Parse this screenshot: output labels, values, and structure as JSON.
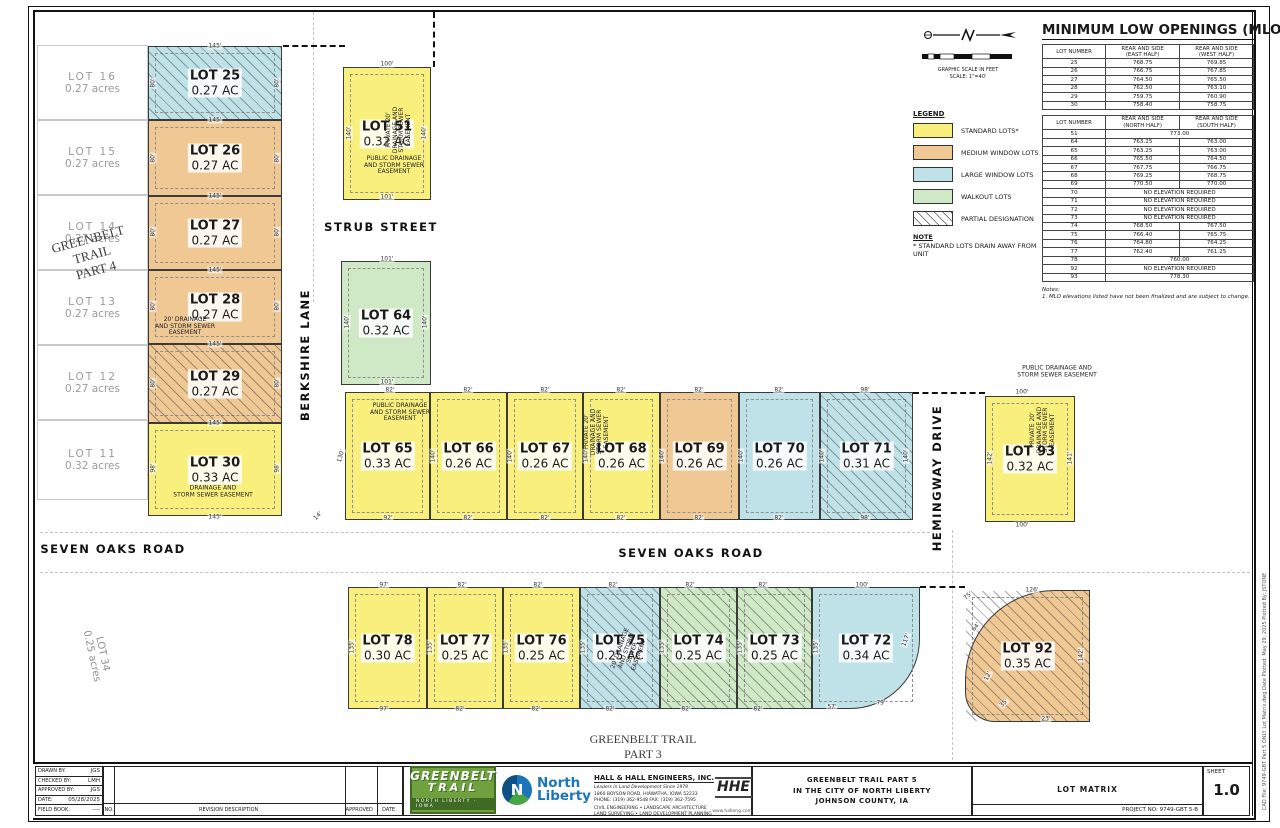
{
  "colors": {
    "standard": "#F8EF7D",
    "medium": "#EFC894",
    "large": "#BFE2E8",
    "walkout": "#CFE8C5",
    "hatch_line": "#555555"
  },
  "mlo": {
    "title": "MINIMUM LOW OPENINGS (MLO):",
    "tables": [
      {
        "headers": [
          "LOT NUMBER",
          "REAR AND SIDE\n(EAST HALF)",
          "REAR AND SIDE\n(WEST HALF)"
        ],
        "rows": [
          [
            "25",
            "768.75",
            "769.85"
          ],
          [
            "26",
            "766.75",
            "767.85"
          ],
          [
            "27",
            "764.50",
            "765.50"
          ],
          [
            "28",
            "762.50",
            "763.10"
          ],
          [
            "29",
            "759.75",
            "760.90"
          ],
          [
            "30",
            "758.40",
            "758.75"
          ]
        ]
      },
      {
        "headers": [
          "LOT NUMBER",
          "REAR AND SIDE\n(NORTH HALF)",
          "REAR AND SIDE\n(SOUTH HALF)"
        ],
        "rows": [
          [
            "51",
            "773.00",
            null
          ],
          [
            "64",
            "763.25",
            "763.00"
          ],
          [
            "65",
            "763.25",
            "763.00"
          ],
          [
            "66",
            "765.50",
            "764.50"
          ],
          [
            "67",
            "767.75",
            "766.75"
          ],
          [
            "68",
            "769.25",
            "768.75"
          ],
          [
            "69",
            "770.50",
            "770.00"
          ],
          [
            "70",
            "NO ELEVATION REQUIRED",
            null
          ],
          [
            "71",
            "NO ELEVATION REQUIRED",
            null
          ],
          [
            "72",
            "NO ELEVATION REQUIRED",
            null
          ],
          [
            "73",
            "NO ELEVATION REQUIRED",
            null
          ],
          [
            "74",
            "768.50",
            "767.50"
          ],
          [
            "75",
            "766.40",
            "765.75"
          ],
          [
            "76",
            "764.80",
            "764.25"
          ],
          [
            "77",
            "762.40",
            "761.25"
          ],
          [
            "78",
            "760.00",
            null
          ],
          [
            "92",
            "NO ELEVATION REQUIRED",
            null
          ],
          [
            "93",
            "778.30",
            null
          ]
        ]
      }
    ],
    "notes_label": "Notes:",
    "notes": "1.  MLO elevations listed have not been finalized and are subject to change."
  },
  "legend": {
    "title": "LEGEND",
    "items": [
      {
        "label": "STANDARD LOTS*",
        "type": "standard",
        "hatch": false
      },
      {
        "label": "MEDIUM WINDOW LOTS",
        "type": "medium",
        "hatch": false
      },
      {
        "label": "LARGE WINDOW LOTS",
        "type": "large",
        "hatch": false
      },
      {
        "label": "WALKOUT LOTS",
        "type": "walkout",
        "hatch": false
      },
      {
        "label": "PARTIAL DESIGNATION",
        "type": "none",
        "hatch": true
      }
    ],
    "note_title": "NOTE",
    "note": "* STANDARD LOTS DRAIN AWAY FROM UNIT"
  },
  "scale": {
    "caption1": "GRAPHIC SCALE IN FEET",
    "caption2": "SCALE: 1\"=40'"
  },
  "lots": [
    {
      "id": "25",
      "name": "LOT 25",
      "ac": "0.27 AC",
      "x": 148,
      "y": 46,
      "w": 134,
      "h": 74,
      "type": "large",
      "hatch": true
    },
    {
      "id": "26",
      "name": "LOT 26",
      "ac": "0.27 AC",
      "x": 148,
      "y": 120,
      "w": 134,
      "h": 76,
      "type": "medium",
      "hatch": false
    },
    {
      "id": "27",
      "name": "LOT 27",
      "ac": "0.27 AC",
      "x": 148,
      "y": 196,
      "w": 134,
      "h": 74,
      "type": "medium",
      "hatch": false
    },
    {
      "id": "28",
      "name": "LOT 28",
      "ac": "0.27 AC",
      "x": 148,
      "y": 270,
      "w": 134,
      "h": 74,
      "type": "medium",
      "hatch": false
    },
    {
      "id": "29",
      "name": "LOT 29",
      "ac": "0.27 AC",
      "x": 148,
      "y": 344,
      "w": 134,
      "h": 79,
      "type": "medium",
      "hatch": true
    },
    {
      "id": "30",
      "name": "LOT 30",
      "ac": "0.33 AC",
      "x": 148,
      "y": 423,
      "w": 134,
      "h": 93,
      "type": "standard",
      "hatch": false
    },
    {
      "id": "51",
      "name": "LOT 51",
      "ac": "0.32 AC",
      "x": 343,
      "y": 67,
      "w": 88,
      "h": 133,
      "type": "standard",
      "hatch": false
    },
    {
      "id": "64",
      "name": "LOT 64",
      "ac": "0.32 AC",
      "x": 341,
      "y": 261,
      "w": 90,
      "h": 124,
      "type": "walkout",
      "hatch": false
    },
    {
      "id": "65",
      "name": "LOT 65",
      "ac": "0.33 AC",
      "x": 345,
      "y": 392,
      "w": 85,
      "h": 128,
      "type": "standard",
      "hatch": false
    },
    {
      "id": "66",
      "name": "LOT 66",
      "ac": "0.26 AC",
      "x": 430,
      "y": 392,
      "w": 77,
      "h": 128,
      "type": "standard",
      "hatch": false
    },
    {
      "id": "67",
      "name": "LOT 67",
      "ac": "0.26 AC",
      "x": 507,
      "y": 392,
      "w": 76,
      "h": 128,
      "type": "standard",
      "hatch": false
    },
    {
      "id": "68",
      "name": "LOT 68",
      "ac": "0.26 AC",
      "x": 583,
      "y": 392,
      "w": 77,
      "h": 128,
      "type": "standard",
      "hatch": false
    },
    {
      "id": "69",
      "name": "LOT 69",
      "ac": "0.26 AC",
      "x": 660,
      "y": 392,
      "w": 79,
      "h": 128,
      "type": "medium",
      "hatch": false
    },
    {
      "id": "70",
      "name": "LOT 70",
      "ac": "0.26 AC",
      "x": 739,
      "y": 392,
      "w": 81,
      "h": 128,
      "type": "large",
      "hatch": false
    },
    {
      "id": "71",
      "name": "LOT 71",
      "ac": "0.31 AC",
      "x": 820,
      "y": 392,
      "w": 93,
      "h": 128,
      "type": "large",
      "hatch": true
    },
    {
      "id": "93",
      "name": "LOT 93",
      "ac": "0.32 AC",
      "x": 985,
      "y": 396,
      "w": 90,
      "h": 126,
      "type": "standard",
      "hatch": false
    },
    {
      "id": "78",
      "name": "LOT 78",
      "ac": "0.30 AC",
      "x": 348,
      "y": 587,
      "w": 79,
      "h": 122,
      "type": "standard",
      "hatch": false
    },
    {
      "id": "77",
      "name": "LOT 77",
      "ac": "0.25 AC",
      "x": 427,
      "y": 587,
      "w": 76,
      "h": 122,
      "type": "standard",
      "hatch": false
    },
    {
      "id": "76",
      "name": "LOT 76",
      "ac": "0.25 AC",
      "x": 503,
      "y": 587,
      "w": 77,
      "h": 122,
      "type": "standard",
      "hatch": false
    },
    {
      "id": "75",
      "name": "LOT 75",
      "ac": "0.25 AC",
      "x": 580,
      "y": 587,
      "w": 80,
      "h": 122,
      "type": "large",
      "hatch": true
    },
    {
      "id": "74",
      "name": "LOT 74",
      "ac": "0.25 AC",
      "x": 660,
      "y": 587,
      "w": 77,
      "h": 122,
      "type": "walkout",
      "hatch": true
    },
    {
      "id": "73",
      "name": "LOT 73",
      "ac": "0.25 AC",
      "x": 737,
      "y": 587,
      "w": 75,
      "h": 122,
      "type": "walkout",
      "hatch": true
    },
    {
      "id": "72",
      "name": "LOT 72",
      "ac": "0.34 AC",
      "x": 812,
      "y": 587,
      "w": 108,
      "h": 122,
      "type": "large",
      "hatch": false,
      "radius": "0 0 70px 0"
    },
    {
      "id": "92",
      "name": "LOT 92",
      "ac": "0.35 AC",
      "x": 965,
      "y": 590,
      "w": 125,
      "h": 132,
      "type": "medium",
      "hatch": true,
      "radius": "90px 0 0 30px"
    }
  ],
  "ghost_lots": [
    {
      "name": "LOT 16",
      "acres": "0.27 acres",
      "x": 37,
      "y": 45,
      "w": 111,
      "h": 75
    },
    {
      "name": "LOT 15",
      "acres": "0.27 acres",
      "x": 37,
      "y": 120,
      "w": 111,
      "h": 75
    },
    {
      "name": "LOT 14",
      "acres": "0.27 acres",
      "x": 37,
      "y": 195,
      "w": 111,
      "h": 75
    },
    {
      "name": "LOT 13",
      "acres": "0.27 acres",
      "x": 37,
      "y": 270,
      "w": 111,
      "h": 75
    },
    {
      "name": "LOT 12",
      "acres": "0.27 acres",
      "x": 37,
      "y": 345,
      "w": 111,
      "h": 75
    },
    {
      "name": "LOT 11",
      "acres": "0.32 acres",
      "x": 37,
      "y": 420,
      "w": 111,
      "h": 80
    }
  ],
  "ghost_labels": [
    {
      "t": "GREENBELT\nTRAIL\nPART  4",
      "x": 92,
      "y": 255,
      "r": -15,
      "size": 13,
      "dark": true
    },
    {
      "t": "GREENBELT  TRAIL\nPART  3",
      "x": 643,
      "y": 747,
      "r": 0,
      "size": 12,
      "dark": true
    },
    {
      "t": "LOT 34\n0.25 acres",
      "x": 97,
      "y": 655,
      "r": 78,
      "size": 10,
      "dark": false
    }
  ],
  "streets": [
    {
      "t": "STRUB STREET",
      "x": 381,
      "y": 227,
      "r": 0
    },
    {
      "t": "BERKSHIRE LANE",
      "x": 305,
      "y": 355,
      "r": -90
    },
    {
      "t": "SEVEN OAKS ROAD",
      "x": 113,
      "y": 549,
      "r": 0
    },
    {
      "t": "SEVEN OAKS ROAD",
      "x": 691,
      "y": 553,
      "r": 0
    },
    {
      "t": "HEMINGWAY DRIVE",
      "x": 937,
      "y": 478,
      "r": -90
    }
  ],
  "annotations": [
    {
      "t": "PRIVATE 20'\nDRAINAGE AND\nSTORM SEWER\nEASEMENT",
      "x": 399,
      "y": 130,
      "r": -90
    },
    {
      "t": "PUBLIC DRAINAGE\nAND STORM SEWER\nEASEMENT",
      "x": 394,
      "y": 166,
      "r": 0
    },
    {
      "t": "20' DRAINAGE\nAND STORM SEWER\nEASEMENT",
      "x": 185,
      "y": 327,
      "r": 0
    },
    {
      "t": "DRAINAGE AND\nSTORM SEWER EASEMENT",
      "x": 213,
      "y": 492,
      "r": 0
    },
    {
      "t": "PUBLIC DRAINAGE\nAND STORM SEWER\nEASEMENT",
      "x": 400,
      "y": 413,
      "r": 0
    },
    {
      "t": "PRIVATE 20'\nDRAINAGE AND\nSTORM SEWER\nEASEMENT",
      "x": 597,
      "y": 432,
      "r": -90
    },
    {
      "t": "PUBLIC DRAINAGE AND\nSTORM SEWER EASEMENT",
      "x": 1057,
      "y": 372,
      "r": 0
    },
    {
      "t": "PRIVATE 20'\nDRAINAGE AND\nSTORM SEWER\nEASEMENT",
      "x": 1043,
      "y": 430,
      "r": -90
    },
    {
      "t": "20' DRAINAGE\nAND STORM\nSEWER\nEASEMENT",
      "x": 630,
      "y": 652,
      "r": -70
    }
  ],
  "dims": [
    [
      "145'",
      215,
      46
    ],
    [
      "145'",
      215,
      120
    ],
    [
      "145'",
      215,
      196
    ],
    [
      "145'",
      215,
      270
    ],
    [
      "145'",
      215,
      344
    ],
    [
      "145'",
      215,
      423
    ],
    [
      "145'",
      215,
      517
    ],
    [
      "80'",
      153,
      83,
      -90
    ],
    [
      "80'",
      277,
      83,
      -90
    ],
    [
      "80'",
      153,
      158,
      -90
    ],
    [
      "80'",
      277,
      158,
      -90
    ],
    [
      "80'",
      153,
      232,
      -90
    ],
    [
      "80'",
      277,
      232,
      -90
    ],
    [
      "80'",
      153,
      306,
      -90
    ],
    [
      "80'",
      277,
      306,
      -90
    ],
    [
      "80'",
      153,
      383,
      -90
    ],
    [
      "80'",
      277,
      383,
      -90
    ],
    [
      "98'",
      153,
      468,
      -90
    ],
    [
      "98'",
      277,
      468,
      -90
    ],
    [
      "100'",
      387,
      64
    ],
    [
      "140'",
      349,
      133,
      -90
    ],
    [
      "140'",
      424,
      133,
      -90
    ],
    [
      "101'",
      387,
      197
    ],
    [
      "101'",
      387,
      259
    ],
    [
      "140'",
      347,
      322,
      -90
    ],
    [
      "140'",
      425,
      322,
      -90
    ],
    [
      "101'",
      387,
      382
    ],
    [
      "82'",
      390,
      390
    ],
    [
      "82'",
      468,
      390
    ],
    [
      "82'",
      545,
      390
    ],
    [
      "82'",
      621,
      390
    ],
    [
      "82'",
      699,
      390
    ],
    [
      "82'",
      779,
      390
    ],
    [
      "98'",
      865,
      390
    ],
    [
      "92'",
      388,
      518
    ],
    [
      "82'",
      468,
      518
    ],
    [
      "82'",
      545,
      518
    ],
    [
      "82'",
      621,
      518
    ],
    [
      "82'",
      699,
      518
    ],
    [
      "82'",
      779,
      518
    ],
    [
      "98'",
      865,
      518
    ],
    [
      "140'",
      433,
      456,
      -90
    ],
    [
      "140'",
      510,
      456,
      -90
    ],
    [
      "140'",
      586,
      456,
      -90
    ],
    [
      "140'",
      662,
      456,
      -90
    ],
    [
      "140'",
      741,
      456,
      -90
    ],
    [
      "140'",
      822,
      456,
      -90
    ],
    [
      "140'",
      906,
      456,
      -90
    ],
    [
      "130'",
      341,
      456,
      -75
    ],
    [
      "14'",
      318,
      516,
      -45
    ],
    [
      "100'",
      1022,
      392
    ],
    [
      "142'",
      990,
      458,
      -90
    ],
    [
      "141'",
      1070,
      458,
      -90
    ],
    [
      "100'",
      1022,
      525
    ],
    [
      "97'",
      384,
      585
    ],
    [
      "82'",
      462,
      585
    ],
    [
      "82'",
      538,
      585
    ],
    [
      "82'",
      613,
      585
    ],
    [
      "82'",
      690,
      585
    ],
    [
      "82'",
      763,
      585
    ],
    [
      "100'",
      862,
      585
    ],
    [
      "97'",
      384,
      709
    ],
    [
      "82'",
      460,
      709
    ],
    [
      "82'",
      536,
      709
    ],
    [
      "82'",
      610,
      709
    ],
    [
      "82'",
      686,
      709
    ],
    [
      "82'",
      758,
      709
    ],
    [
      "57'",
      832,
      707
    ],
    [
      "79'",
      881,
      703
    ],
    [
      "135'",
      352,
      647,
      -90
    ],
    [
      "135'",
      430,
      647,
      -90
    ],
    [
      "135'",
      506,
      647,
      -90
    ],
    [
      "135'",
      583,
      647,
      -90
    ],
    [
      "135'",
      662,
      647,
      -90
    ],
    [
      "135'",
      740,
      647,
      -90
    ],
    [
      "135'",
      816,
      647,
      -90
    ],
    [
      "117'",
      906,
      640,
      -70
    ],
    [
      "126'",
      1032,
      590
    ],
    [
      "142'",
      1081,
      655,
      -90
    ],
    [
      "75'",
      968,
      596,
      -40
    ],
    [
      "64'",
      976,
      627,
      -50
    ],
    [
      "12'",
      988,
      676,
      -65
    ],
    [
      "35'",
      1004,
      703,
      -45
    ],
    [
      "23'",
      1046,
      719
    ]
  ],
  "titleblock": {
    "info_rows": [
      [
        "DRAWN BY:",
        "JGS"
      ],
      [
        "CHECKED BY:",
        "LMH"
      ],
      [
        "APPROVED BY:",
        "JGS"
      ],
      [
        "DATE:",
        "05/28/2025"
      ],
      [
        "FIELD BOOK:",
        "----"
      ]
    ],
    "rev_no": "NO.",
    "rev_desc": "REVISION DESCRIPTION",
    "rev_approved": "APPROVED",
    "rev_date": "DATE",
    "firm_name": "HALL & HALL ENGINEERS, INC.",
    "firm_tagline": "Leaders in Land Development Since 1979",
    "firm_address": "1860 BOYSON ROAD, HIAWATHA, IOWA 52233",
    "firm_phone": "PHONE: (319) 362-9548   FAX: (319) 362-7595",
    "firm_services1": "CIVIL ENGINEERING • LANDSCAPE ARCHITECTURE",
    "firm_services2": "LAND SURVEYING • LAND DEVELOPMENT PLANNING",
    "firm_web": "www.halleng.com",
    "hhe": "HHE",
    "project_title1": "GREENBELT TRAIL PART 5",
    "project_title2": "IN THE CITY OF NORTH LIBERTY",
    "project_title3": "JOHNSON COUNTY, IA",
    "sheet_title": "LOT MATRIX",
    "project_no": "PROJECT NO:   9749-GBT 5-B",
    "sheet_label": "SHEET",
    "sheet_no": "1.0",
    "logo1_line1": "GREENBELT",
    "logo1_line2": "TRAIL",
    "logo1_line3": "NORTH LIBERTY · IOWA",
    "logo2_name": "North\nLiberty",
    "logo2_letter": "N"
  },
  "side_text": "CAD File: 9749-GBT Part 5 ONLY Lot Matrix.dwg     Date Plotted: May 29, 2025     Plotted By: JSTONE"
}
